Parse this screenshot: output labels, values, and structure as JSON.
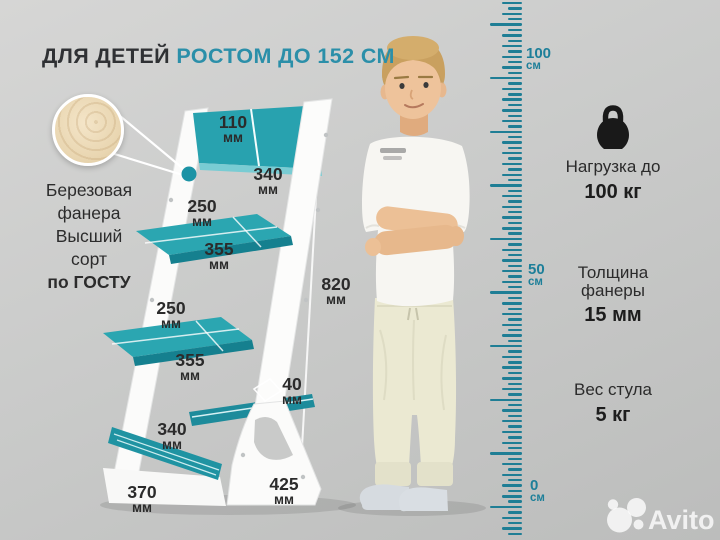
{
  "title": {
    "dark": "ДЛЯ ДЕТЕЙ",
    "accent": "РОСТОМ ДО 152 СМ"
  },
  "material_callout": {
    "lines": [
      "Березовая",
      "фанера",
      "Высший",
      "сорт"
    ],
    "emphasis": "по ГОСТУ",
    "texture": "birch-plywood-texture"
  },
  "dimensions": {
    "backrest_height": {
      "v": "110",
      "u": "мм"
    },
    "backrest_width": {
      "v": "340",
      "u": "мм"
    },
    "seat_depth": {
      "v": "250",
      "u": "мм"
    },
    "seat_width": {
      "v": "355",
      "u": "мм"
    },
    "chair_height": {
      "v": "820",
      "u": "мм"
    },
    "footrest_depth": {
      "v": "250",
      "u": "мм"
    },
    "footrest_width": {
      "v": "355",
      "u": "мм"
    },
    "plank_thickness": {
      "v": "40",
      "u": "мм"
    },
    "crossbar_length": {
      "v": "340",
      "u": "мм"
    },
    "base_depth": {
      "v": "370",
      "u": "мм"
    },
    "base_width": {
      "v": "425",
      "u": "мм"
    }
  },
  "ruler": {
    "marks": [
      {
        "v": "100",
        "u": "см"
      },
      {
        "v": "50",
        "u": "см"
      },
      {
        "v": "0",
        "u": "см"
      }
    ]
  },
  "features": [
    {
      "icon": "kettlebell-icon",
      "label": "Нагрузка до",
      "value": "100 кг"
    },
    {
      "icon": null,
      "label": "Толщина фанеры",
      "value": "15 мм"
    },
    {
      "icon": null,
      "label": "Вес стула",
      "value": "5 кг"
    }
  ],
  "watermark": {
    "brand": "Avito"
  },
  "colors": {
    "accent_teal": "#2b8fa9",
    "chair_teal": "#2ba6b1",
    "ruler_teal": "#1f7e95"
  }
}
